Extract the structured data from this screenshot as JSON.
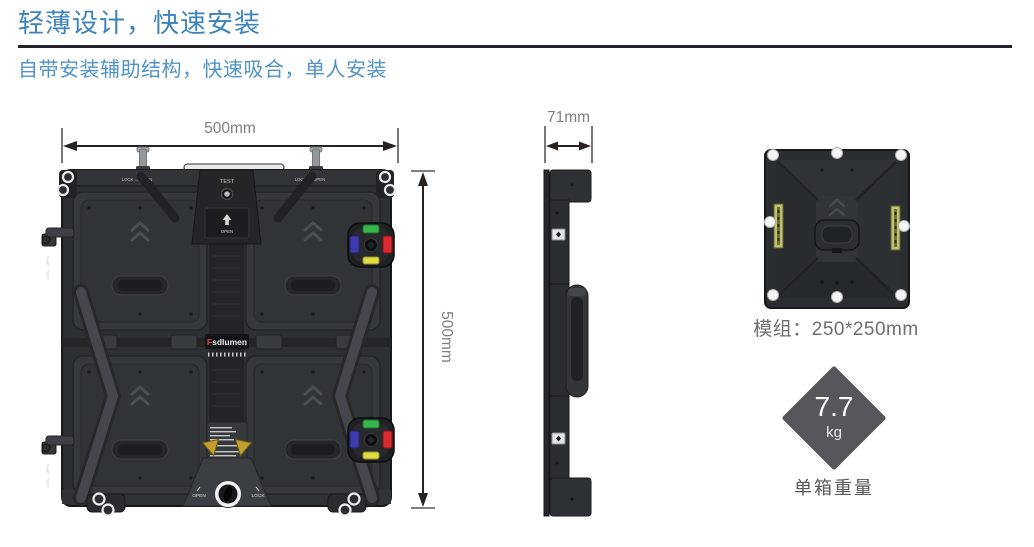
{
  "header": {
    "title": "轻薄设计，快速安装",
    "subtitle": "自带安装辅助结构，快速吸合，单人安装"
  },
  "front_view": {
    "width_label": "500mm",
    "height_label": "500mm",
    "cabinet": {
      "latch_label": "LOCK ↔ OPEN",
      "test_label": "TEST",
      "open_label": "OPEN",
      "knob_open_label": "OPEN",
      "knob_lock_label": "LOCK",
      "brand_initial": "F",
      "brand_rest": "sdlumen"
    }
  },
  "side_view": {
    "depth_label": "71mm"
  },
  "module_view": {
    "caption": "模组：250*250mm"
  },
  "weight": {
    "value": "7.7",
    "unit": "kg",
    "caption": "单箱重量"
  },
  "colors": {
    "title_blue": "#3c83bd",
    "subtitle_blue": "#4f93c9",
    "divider_dark": "#222228",
    "dimension_ink": "#272220",
    "dimension_text_gray": "#7d7f82",
    "cabinet_dark": "#2d3032",
    "connector_green": "#38b54b",
    "connector_blue": "#3c3cae",
    "connector_red": "#d92b2e",
    "connector_yellow": "#e0dc42",
    "warning_yellow": "#c59f2e",
    "weight_diamond_gray": "#55575a"
  }
}
